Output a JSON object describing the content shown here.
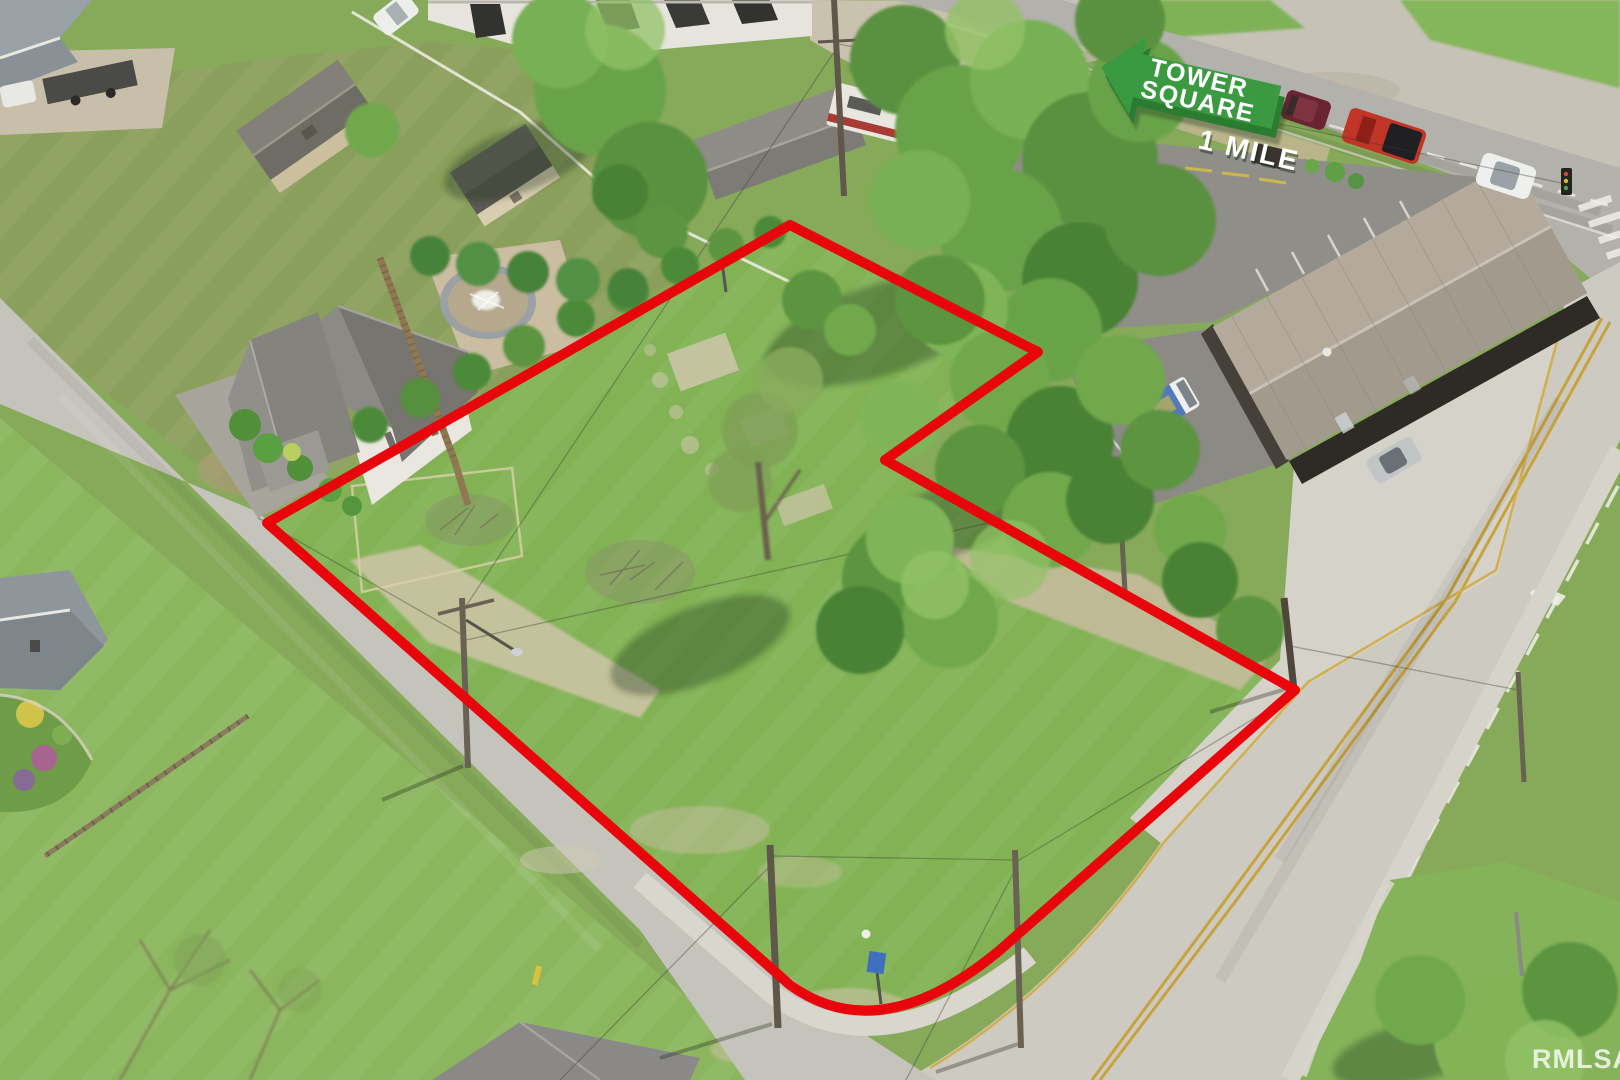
{
  "sign": {
    "line1": "TOWER",
    "line2": "SQUARE",
    "distance": "1 MILE",
    "arrow_color": "#3b9a41",
    "arrow_edge_color": "#2a7c31",
    "text_color": "#ffffff"
  },
  "boundary": {
    "color": "#e8050b"
  },
  "watermark": {
    "text": "RMLSA",
    "color": "#ffffff"
  }
}
